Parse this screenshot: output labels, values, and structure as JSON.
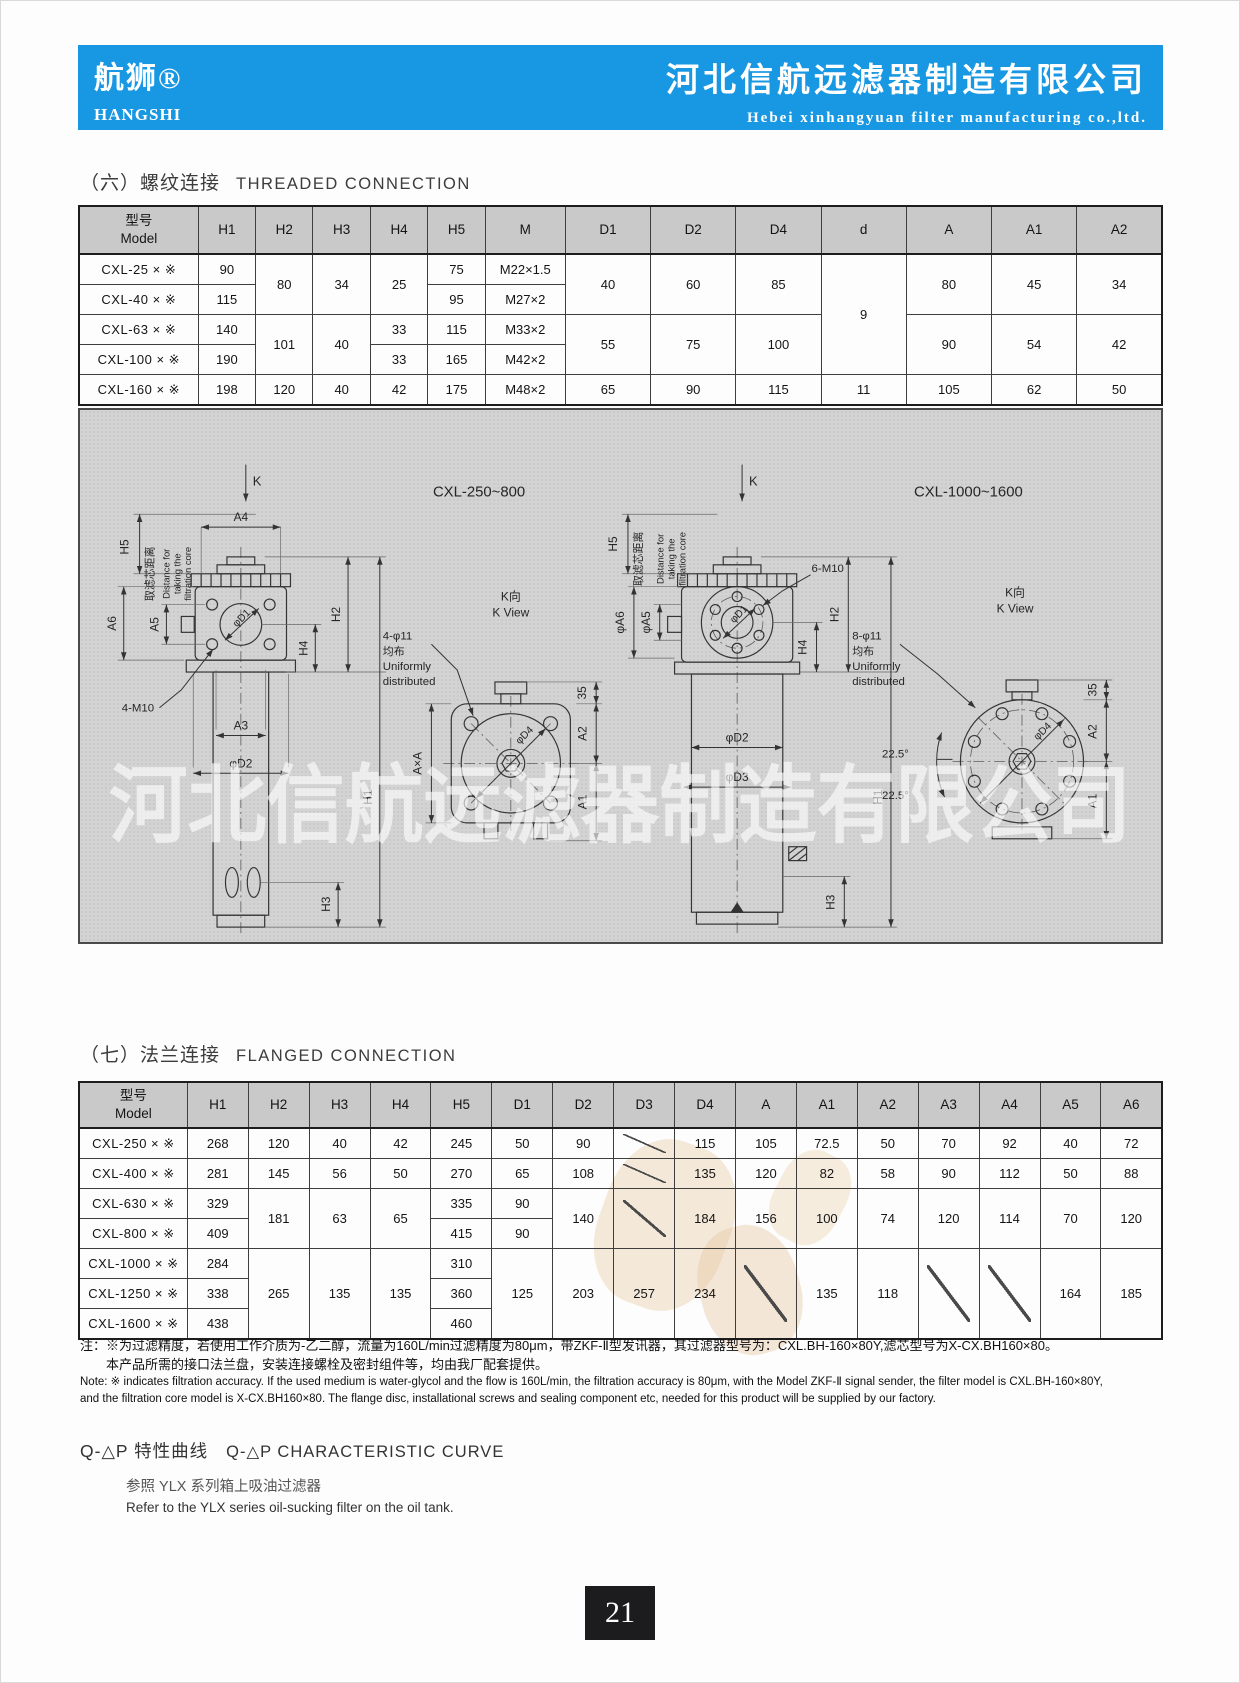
{
  "header": {
    "brand_cn": "航狮®",
    "brand_en": "HANGSHI",
    "company_cn": "河北信航远滤器制造有限公司",
    "company_en": "Hebei xinhangyuan filter manufacturing co.,ltd.",
    "bg_color": "#1897e2"
  },
  "sections": {
    "threaded_cn": "（六）螺纹连接",
    "threaded_en": "THREADED CONNECTION",
    "flanged_cn": "（七）法兰连接",
    "flanged_en": "FLANGED CONNECTION"
  },
  "threaded_table": {
    "headers": [
      "型号\nModel",
      "H1",
      "H2",
      "H3",
      "H4",
      "H5",
      "M",
      "D1",
      "D2",
      "D4",
      "d",
      "A",
      "A1",
      "A2"
    ],
    "rows": [
      [
        {
          "v": "CXL-25 × ※"
        },
        {
          "v": "90"
        },
        {
          "v": "80",
          "rs": 2
        },
        {
          "v": "34",
          "rs": 2
        },
        {
          "v": "25",
          "rs": 2
        },
        {
          "v": "75"
        },
        {
          "v": "M22×1.5"
        },
        {
          "v": "40",
          "rs": 2
        },
        {
          "v": "60",
          "rs": 2
        },
        {
          "v": "85",
          "rs": 2
        },
        {
          "v": "9",
          "rs": 4
        },
        {
          "v": "80",
          "rs": 2
        },
        {
          "v": "45",
          "rs": 2
        },
        {
          "v": "34",
          "rs": 2
        }
      ],
      [
        {
          "v": "CXL-40 × ※"
        },
        {
          "v": "115"
        },
        {
          "v": "95"
        },
        {
          "v": "M27×2"
        }
      ],
      [
        {
          "v": "CXL-63 × ※"
        },
        {
          "v": "140"
        },
        {
          "v": "101",
          "rs": 2
        },
        {
          "v": "40",
          "rs": 2
        },
        {
          "v": "33"
        },
        {
          "v": "115"
        },
        {
          "v": "M33×2"
        },
        {
          "v": "55",
          "rs": 2
        },
        {
          "v": "75",
          "rs": 2
        },
        {
          "v": "100",
          "rs": 2
        },
        {
          "v": "90",
          "rs": 2
        },
        {
          "v": "54",
          "rs": 2
        },
        {
          "v": "42",
          "rs": 2
        }
      ],
      [
        {
          "v": "CXL-100 × ※"
        },
        {
          "v": "190"
        },
        {
          "v": "33"
        },
        {
          "v": "165"
        },
        {
          "v": "M42×2"
        }
      ],
      [
        {
          "v": "CXL-160 × ※"
        },
        {
          "v": "198"
        },
        {
          "v": "120"
        },
        {
          "v": "40"
        },
        {
          "v": "42"
        },
        {
          "v": "175"
        },
        {
          "v": "M48×2"
        },
        {
          "v": "65"
        },
        {
          "v": "90"
        },
        {
          "v": "115"
        },
        {
          "v": "11"
        },
        {
          "v": "105"
        },
        {
          "v": "62"
        },
        {
          "v": "50"
        }
      ]
    ]
  },
  "flanged_table": {
    "headers": [
      "型号\nModel",
      "H1",
      "H2",
      "H3",
      "H4",
      "H5",
      "D1",
      "D2",
      "D3",
      "D4",
      "A",
      "A1",
      "A2",
      "A3",
      "A4",
      "A5",
      "A6"
    ],
    "rows": [
      [
        {
          "v": "CXL-250 × ※"
        },
        {
          "v": "268"
        },
        {
          "v": "120"
        },
        {
          "v": "40"
        },
        {
          "v": "42"
        },
        {
          "v": "245"
        },
        {
          "v": "50"
        },
        {
          "v": "90"
        },
        {
          "slash": true
        },
        {
          "v": "115"
        },
        {
          "v": "105"
        },
        {
          "v": "72.5"
        },
        {
          "v": "50"
        },
        {
          "v": "70"
        },
        {
          "v": "92"
        },
        {
          "v": "40"
        },
        {
          "v": "72"
        }
      ],
      [
        {
          "v": "CXL-400 × ※"
        },
        {
          "v": "281"
        },
        {
          "v": "145"
        },
        {
          "v": "56"
        },
        {
          "v": "50"
        },
        {
          "v": "270"
        },
        {
          "v": "65"
        },
        {
          "v": "108"
        },
        {
          "slash": true
        },
        {
          "v": "135"
        },
        {
          "v": "120"
        },
        {
          "v": "82"
        },
        {
          "v": "58"
        },
        {
          "v": "90"
        },
        {
          "v": "112"
        },
        {
          "v": "50"
        },
        {
          "v": "88"
        }
      ],
      [
        {
          "v": "CXL-630 × ※"
        },
        {
          "v": "329"
        },
        {
          "v": "181",
          "rs": 2
        },
        {
          "v": "63",
          "rs": 2
        },
        {
          "v": "65",
          "rs": 2
        },
        {
          "v": "335"
        },
        {
          "v": "90"
        },
        {
          "v": "140",
          "rs": 2
        },
        {
          "slash": true,
          "rs": 2
        },
        {
          "v": "184",
          "rs": 2
        },
        {
          "v": "156",
          "rs": 2
        },
        {
          "v": "100",
          "rs": 2
        },
        {
          "v": "74",
          "rs": 2
        },
        {
          "v": "120",
          "rs": 2
        },
        {
          "v": "114",
          "rs": 2
        },
        {
          "v": "70",
          "rs": 2
        },
        {
          "v": "120",
          "rs": 2
        }
      ],
      [
        {
          "v": "CXL-800 × ※"
        },
        {
          "v": "409"
        },
        {
          "v": "415"
        },
        {
          "v": "90"
        }
      ],
      [
        {
          "v": "CXL-1000 × ※"
        },
        {
          "v": "284"
        },
        {
          "v": "265",
          "rs": 3
        },
        {
          "v": "135",
          "rs": 3
        },
        {
          "v": "135",
          "rs": 3
        },
        {
          "v": "310"
        },
        {
          "v": "125",
          "rs": 3
        },
        {
          "v": "203",
          "rs": 3
        },
        {
          "v": "257",
          "rs": 3
        },
        {
          "v": "234",
          "rs": 3
        },
        {
          "slash": true,
          "rs": 3
        },
        {
          "v": "135",
          "rs": 3
        },
        {
          "v": "118",
          "rs": 3
        },
        {
          "slash": true,
          "rs": 3
        },
        {
          "slash": true,
          "rs": 3
        },
        {
          "v": "164",
          "rs": 3
        },
        {
          "v": "185",
          "rs": 3
        }
      ],
      [
        {
          "v": "CXL-1250 × ※"
        },
        {
          "v": "338"
        },
        {
          "v": "360"
        }
      ],
      [
        {
          "v": "CXL-1600 × ※"
        },
        {
          "v": "438"
        },
        {
          "v": "460"
        }
      ]
    ]
  },
  "drawing": {
    "watermark": "河北信航远滤器制造有限公司",
    "labels": [
      {
        "t": "K",
        "x": 172,
        "y": 76,
        "s": 13,
        "a": "s"
      },
      {
        "t": "A4",
        "x": 160,
        "y": 112
      },
      {
        "t": "H5",
        "x": 47,
        "y": 138,
        "r": -90
      },
      {
        "t": "取滤芯距离",
        "x": 72,
        "y": 165,
        "r": -90,
        "s": 11
      },
      {
        "t": "Distance for",
        "x": 88,
        "y": 165,
        "r": -90,
        "s": 9.5
      },
      {
        "t": "taking the",
        "x": 99,
        "y": 165,
        "r": -90,
        "s": 9.5
      },
      {
        "t": "filtration core",
        "x": 110,
        "y": 165,
        "r": -90,
        "s": 9.5
      },
      {
        "t": "A6",
        "x": 34,
        "y": 215,
        "r": -90
      },
      {
        "t": "A5",
        "x": 77,
        "y": 216,
        "r": -90
      },
      {
        "t": "φD1",
        "x": 163,
        "y": 212,
        "r": -45,
        "s": 10.5
      },
      {
        "t": "4-M10",
        "x": 40,
        "y": 304,
        "s": 11.5,
        "a": "s"
      },
      {
        "t": "H4",
        "x": 227,
        "y": 240,
        "r": -90
      },
      {
        "t": "H2",
        "x": 260,
        "y": 206,
        "r": -90
      },
      {
        "t": "H1",
        "x": 292,
        "y": 390,
        "r": -90
      },
      {
        "t": "A3",
        "x": 160,
        "y": 322
      },
      {
        "t": "φD2",
        "x": 160,
        "y": 360
      },
      {
        "t": "H3",
        "x": 250,
        "y": 498,
        "r": -90
      },
      {
        "t": "CXL-250~800",
        "x": 400,
        "y": 87,
        "s": 15
      },
      {
        "t": "K向",
        "x": 432,
        "y": 192,
        "s": 12
      },
      {
        "t": "K View",
        "x": 432,
        "y": 208,
        "s": 12
      },
      {
        "t": "4-φ11",
        "x": 303,
        "y": 231,
        "s": 11.5,
        "a": "s"
      },
      {
        "t": "均布",
        "x": 303,
        "y": 247,
        "s": 11,
        "a": "s"
      },
      {
        "t": "Uniformly",
        "x": 303,
        "y": 262,
        "s": 11.5,
        "a": "s"
      },
      {
        "t": "distributed",
        "x": 303,
        "y": 277,
        "s": 11.5,
        "a": "s"
      },
      {
        "t": "A×A",
        "x": 342,
        "y": 356,
        "r": -90
      },
      {
        "t": "φD4",
        "x": 448,
        "y": 330,
        "r": -45,
        "s": 10.5
      },
      {
        "t": "35",
        "x": 508,
        "y": 285,
        "r": -90
      },
      {
        "t": "A2",
        "x": 508,
        "y": 326,
        "r": -90
      },
      {
        "t": "A1",
        "x": 508,
        "y": 395,
        "r": -90
      },
      {
        "t": "K",
        "x": 672,
        "y": 76,
        "s": 13,
        "a": "s"
      },
      {
        "t": "CXL-1000~1600",
        "x": 893,
        "y": 87,
        "s": 15
      },
      {
        "t": "H5",
        "x": 539,
        "y": 135,
        "r": -90
      },
      {
        "t": "取滤芯距离",
        "x": 564,
        "y": 150,
        "r": -90,
        "s": 11
      },
      {
        "t": "Distance for",
        "x": 586,
        "y": 150,
        "r": -90,
        "s": 9.5
      },
      {
        "t": "taking the",
        "x": 597,
        "y": 150,
        "r": -90,
        "s": 9.5
      },
      {
        "t": "filtration core",
        "x": 608,
        "y": 150,
        "r": -90,
        "s": 9.5
      },
      {
        "t": "φA6",
        "x": 546,
        "y": 214,
        "r": -90
      },
      {
        "t": "φA5",
        "x": 572,
        "y": 214,
        "r": -90
      },
      {
        "t": "φD1",
        "x": 664,
        "y": 208,
        "r": -45,
        "s": 10.5
      },
      {
        "t": "6-M10",
        "x": 735,
        "y": 163,
        "s": 11.5,
        "a": "s"
      },
      {
        "t": "H4",
        "x": 730,
        "y": 239,
        "r": -90
      },
      {
        "t": "H2",
        "x": 762,
        "y": 206,
        "r": -90
      },
      {
        "t": "H1",
        "x": 806,
        "y": 390,
        "r": -90
      },
      {
        "t": "φD2",
        "x": 660,
        "y": 334
      },
      {
        "t": "φD3",
        "x": 660,
        "y": 374
      },
      {
        "t": "H3",
        "x": 758,
        "y": 496,
        "r": -90
      },
      {
        "t": "K向",
        "x": 940,
        "y": 188,
        "s": 12
      },
      {
        "t": "K View",
        "x": 940,
        "y": 204,
        "s": 12
      },
      {
        "t": "8-φ11",
        "x": 776,
        "y": 231,
        "s": 11.5,
        "a": "s"
      },
      {
        "t": "均布",
        "x": 776,
        "y": 247,
        "s": 11,
        "a": "s"
      },
      {
        "t": "Uniformly",
        "x": 776,
        "y": 262,
        "s": 11.5,
        "a": "s"
      },
      {
        "t": "distributed",
        "x": 776,
        "y": 277,
        "s": 11.5,
        "a": "s"
      },
      {
        "t": "22.5°",
        "x": 806,
        "y": 350,
        "s": 11.5,
        "a": "s"
      },
      {
        "t": "22.5°",
        "x": 806,
        "y": 392,
        "s": 11.5,
        "a": "s"
      },
      {
        "t": "φD4",
        "x": 970,
        "y": 326,
        "r": -45,
        "s": 10.5
      },
      {
        "t": "35",
        "x": 1022,
        "y": 282,
        "r": -90
      },
      {
        "t": "A2",
        "x": 1022,
        "y": 324,
        "r": -90
      },
      {
        "t": "A1",
        "x": 1022,
        "y": 394,
        "r": -90
      }
    ]
  },
  "notes": {
    "cn1": "注：※为过滤精度，若使用工作介质为-乙二醇，流量为160L/min过滤精度为80μm，带ZKF-Ⅱ型发讯器，其过滤器型号为：CXL.BH-160×80Y,滤芯型号为X-CX.BH160×80。",
    "cn2": "本产品所需的接口法兰盘，安装连接螺栓及密封组件等，均由我厂配套提供。",
    "en1": "Note: ※ indicates filtration accuracy. If the used medium is water-glycol and the flow is 160L/min, the filtration accuracy is 80μm, with the Model ZKF-Ⅱ signal sender, the filter model is CXL.BH-160×80Y,",
    "en2": "and the filtration core model is X-CX.BH160×80. The flange disc, installational screws and sealing component etc, needed for this product will be supplied by our factory."
  },
  "curve": {
    "title_cn": "Q-△P 特性曲线",
    "title_en": "Q-△P CHARACTERISTIC CURVE",
    "ref_cn": "参照 YLX 系列箱上吸油过滤器",
    "ref_en": "Refer to the YLX series oil-sucking filter on the oil tank."
  },
  "page": {
    "number": "21"
  }
}
